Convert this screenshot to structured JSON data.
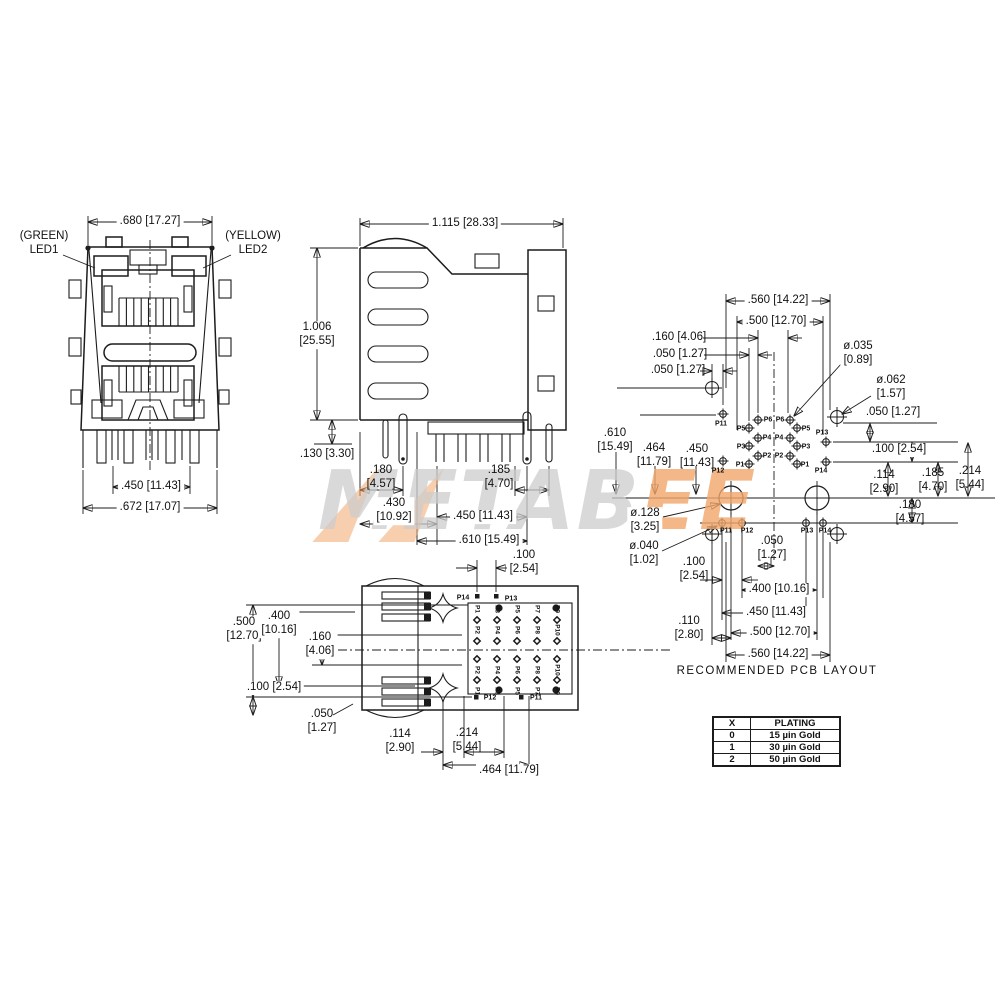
{
  "front_view": {
    "led1": "(GREEN)\nLED1",
    "led2": "(YELLOW)\nLED2",
    "dim_top": ".680 [17.27]",
    "dim_pin_span": ".450 [11.43]",
    "dim_bottom": ".672 [17.07]"
  },
  "side_view": {
    "dim_depth": "1.115 [28.33]",
    "dim_height": "1.006\n[25.55]",
    "dim_standoff": ".130 [3.30]",
    "dim_front_pin": ".180\n[4.57]",
    "dim_pin_gap": ".185\n[4.70]",
    "dim_430": ".430\n[10.92]",
    "dim_450": ".450 [11.43]",
    "dim_610": ".610 [15.49]"
  },
  "bottom_view": {
    "dim_100_top": ".100\n[2.54]",
    "dim_500": ".500\n[12.70]",
    "dim_400": ".400\n[10.16]",
    "dim_160": ".160\n[4.06]",
    "dim_100_left": ".100 [2.54]",
    "dim_050": ".050\n[1.27]",
    "dim_114": ".114\n[2.90]",
    "dim_214": ".214\n[5.44]",
    "dim_464": ".464 [11.79]",
    "pin_p14": "P14",
    "pin_p13": "P13",
    "pin_p12": "P12",
    "pin_p11": "P11",
    "grid": [
      [
        "P1",
        "P3",
        "P5",
        "P7",
        "P9"
      ],
      [
        "P2",
        "P4",
        "P6",
        "P8",
        "P10"
      ],
      [
        "P2",
        "P4",
        "P6",
        "P8",
        "P10"
      ],
      [
        "P1",
        "P3",
        "P5",
        "P7",
        "P9"
      ]
    ]
  },
  "pcb_layout": {
    "title": "RECOMMENDED PCB LAYOUT",
    "dim_560_top": ".560 [14.22]",
    "dim_500_top": ".500 [12.70]",
    "dim_160": ".160 [4.06]",
    "dim_050_a": ".050 [1.27]",
    "dim_050_b": ".050 [1.27]",
    "hole_signal": "ø.035\n[0.89]",
    "hole_corner": "ø.062\n[1.57]",
    "dim_050_right": ".050 [1.27]",
    "dim_100_right": ".100 [2.54]",
    "dim_610": ".610\n[15.49]",
    "dim_464": ".464\n[11.79]",
    "dim_450_left": ".450\n[11.43]",
    "hole_post": "ø.128\n[3.25]",
    "hole_shield": "ø.040\n[1.02]",
    "dim_100_bl": ".100\n[2.54]",
    "dim_050_bc": ".050\n[1.27]",
    "dim_400": ".400 [10.16]",
    "dim_450_b": ".450 [11.43]",
    "dim_110": ".110\n[2.80]",
    "dim_500_b": ".500 [12.70]",
    "dim_560_b": ".560 [14.22]",
    "dim_114": ".114\n[2.90]",
    "dim_185": ".185\n[4.70]",
    "dim_214": ".214\n[5.44]",
    "dim_180": ".180\n[4.57]",
    "left_pins": {
      "p11": "P11",
      "p12": "P12",
      "p1": "P1",
      "p2": "P2",
      "p3": "P3",
      "p4": "P4",
      "p5": "P5",
      "p6": "P6"
    },
    "right_pins": {
      "p13": "P13",
      "p14": "P14",
      "p1": "P1",
      "p2": "P2",
      "p3": "P3",
      "p4": "P4",
      "p5": "P5",
      "p6": "P6"
    },
    "bottom_pins": {
      "p11": "P11",
      "p12": "P12",
      "p13": "P13",
      "p14": "P14"
    }
  },
  "plating_table": {
    "col_x": "X",
    "col_plating": "PLATING",
    "rows": [
      [
        "0",
        "15 µin Gold"
      ],
      [
        "1",
        "30 µin Gold"
      ],
      [
        "2",
        "50 µin Gold"
      ]
    ]
  },
  "watermark": {
    "part1": "METAB",
    "part2": "EE"
  },
  "colors": {
    "line": "#1c1c1c",
    "watermark_gray": "#cdcdcd",
    "watermark_orange": "#f2a76b"
  }
}
